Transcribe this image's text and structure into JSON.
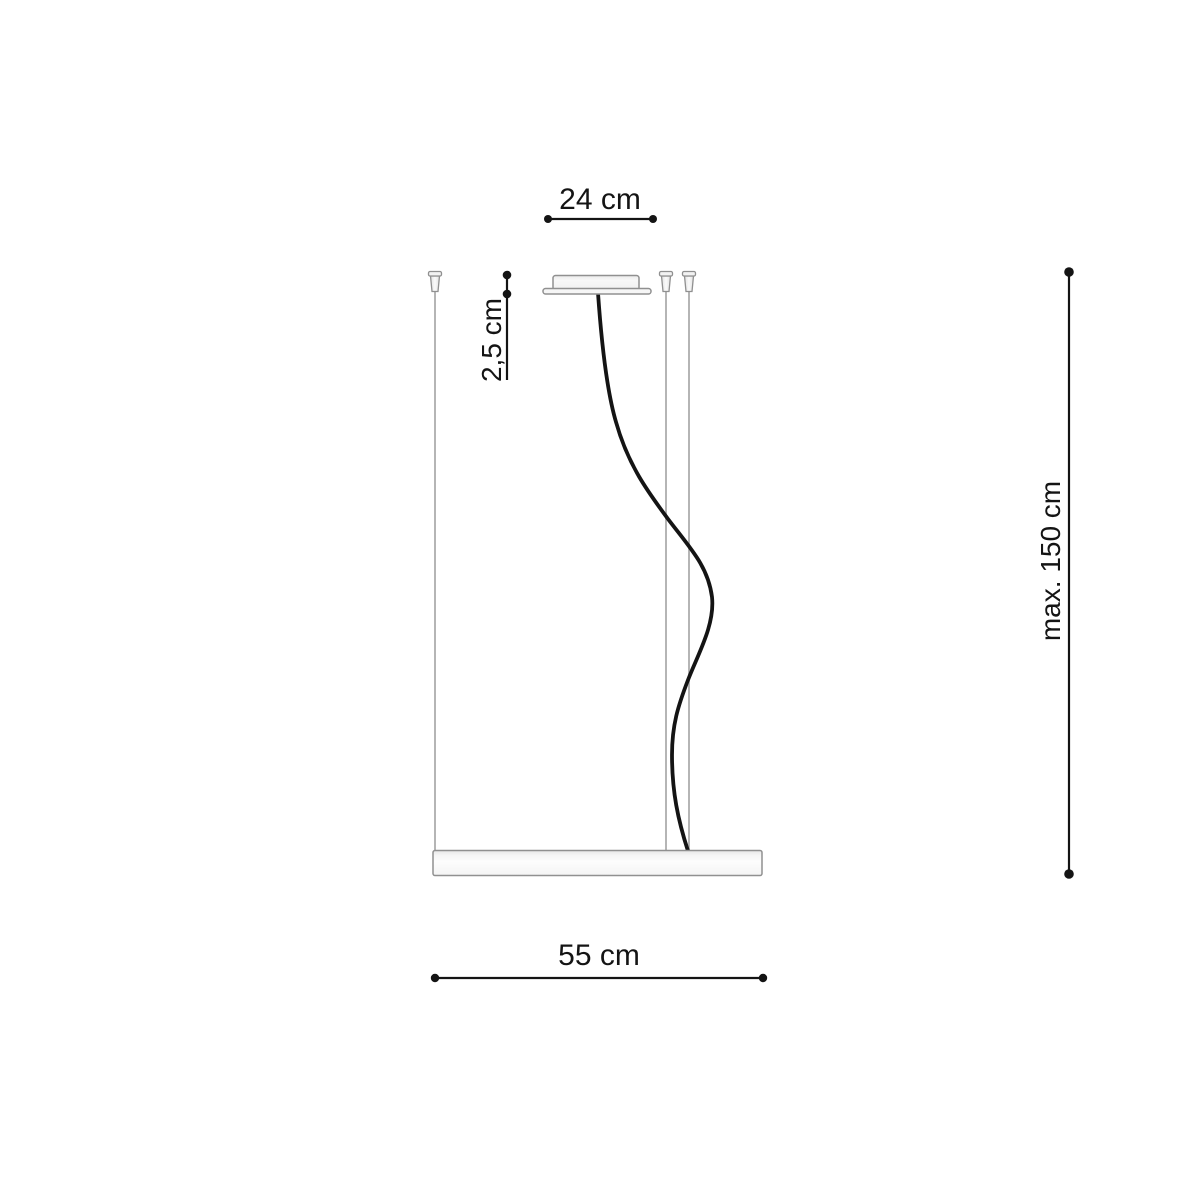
{
  "diagram": {
    "subject": "pendant-lamp-suspension-dimension-drawing",
    "dimensions": {
      "canopy_width": {
        "label": "24 cm",
        "orientation": "horizontal"
      },
      "canopy_height": {
        "label": "2,5 cm",
        "orientation": "vertical"
      },
      "max_drop": {
        "label": "max. 150 cm",
        "orientation": "vertical"
      },
      "fixture_width": {
        "label": "55 cm",
        "orientation": "horizontal"
      }
    },
    "colors": {
      "dimension_line": "#141414",
      "text": "#141414",
      "component_outline": "#909090",
      "component_fill": "#f4f4f4",
      "suspension_wire": "#b5b5b5",
      "power_cable": "#141414",
      "background": "#ffffff"
    }
  }
}
